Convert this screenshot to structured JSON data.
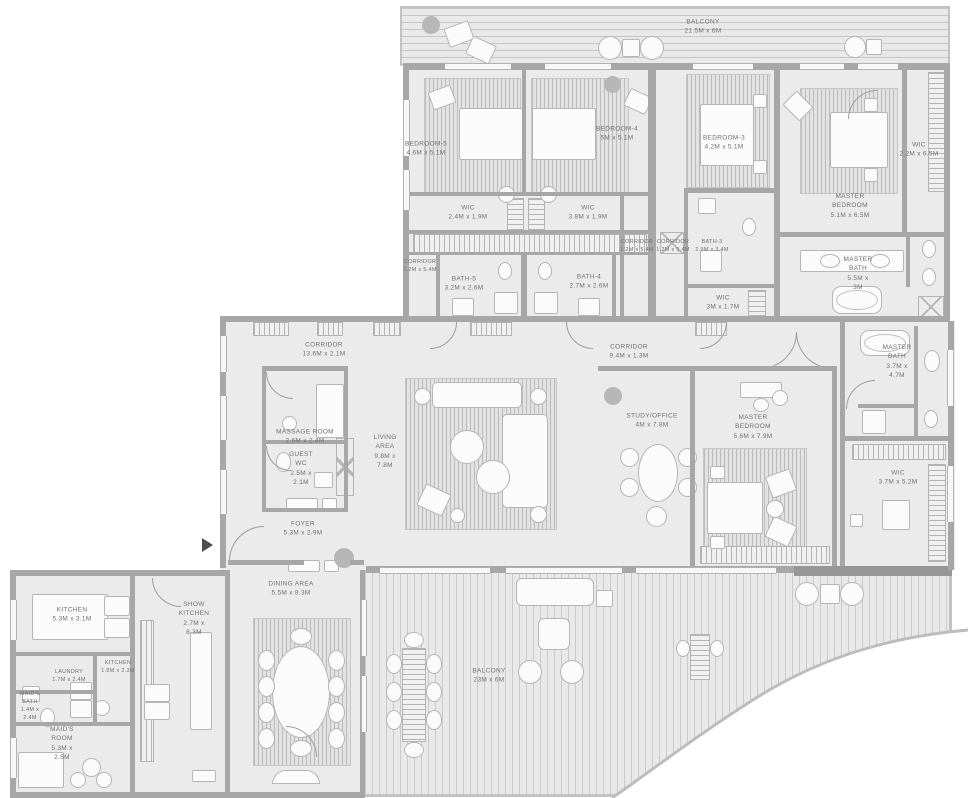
{
  "title": "Penthouse Floor Plan",
  "colors": {
    "wall": "#a7a7a7",
    "floor": "#ebebeb",
    "deck": "#e9e9e9",
    "rug": "#e2e2e2",
    "furniture": "#fbfbfb",
    "text": "#717171",
    "planter": "#b7b7b7"
  },
  "icons": {
    "entry": "entry-arrow"
  },
  "rooms": [
    {
      "id": "balcony-top",
      "name": "BALCONY",
      "dims": "21.5M x 6M"
    },
    {
      "id": "bedroom-5",
      "name": "BEDROOM-5",
      "dims": "4.6M x 5.1M"
    },
    {
      "id": "bedroom-4",
      "name": "BEDROOM-4",
      "dims": "5M x 5.1M"
    },
    {
      "id": "bedroom-3",
      "name": "BEDROOM-3",
      "dims": "4.2M x 5.1M"
    },
    {
      "id": "master-bedroom-upper",
      "name": "MASTER BEDROOM",
      "dims": "5.1M x 6.5M"
    },
    {
      "id": "wic-master-upper",
      "name": "WIC",
      "dims": "2.2M x 6.5M"
    },
    {
      "id": "wic-bedroom-5",
      "name": "WIC",
      "dims": "2.4M x 1.9M"
    },
    {
      "id": "wic-bedroom-4",
      "name": "WIC",
      "dims": "3.8M x 1.9M"
    },
    {
      "id": "corridor-bedroom-5",
      "name": "CORRIDOR",
      "dims": "1.2M x 5.4M"
    },
    {
      "id": "corridor-bedroom-4",
      "name": "CORRIDOR",
      "dims": "1.2M x 5.4M"
    },
    {
      "id": "corridor-bedroom-3",
      "name": "CORRIDOR",
      "dims": "1.2M x 5.4M"
    },
    {
      "id": "bath-5",
      "name": "BATH-5",
      "dims": "3.2M x 2.6M"
    },
    {
      "id": "bath-4",
      "name": "BATH-4",
      "dims": "2.7M x 2.6M"
    },
    {
      "id": "bath-3",
      "name": "BATH-3",
      "dims": "2.9M x 3.4M"
    },
    {
      "id": "wic-bedroom-3",
      "name": "WIC",
      "dims": "3M x 1.7M"
    },
    {
      "id": "master-bath-upper",
      "name": "MASTER BATH",
      "dims": "5.5M x 3M"
    },
    {
      "id": "corridor-main",
      "name": "CORRIDOR",
      "dims": "13.6M x 2.1M"
    },
    {
      "id": "corridor-study",
      "name": "CORRIDOR",
      "dims": "9.4M x 1.3M"
    },
    {
      "id": "massage-room",
      "name": "MASSAGE ROOM",
      "dims": "2.6M x 2.4M"
    },
    {
      "id": "guest-wc",
      "name": "GUEST WC",
      "dims": "2.5M x 2.1M"
    },
    {
      "id": "living-area",
      "name": "LIVING AREA",
      "dims": "9.8M x 7.8M"
    },
    {
      "id": "study-office",
      "name": "STUDY/OFFICE",
      "dims": "4M x 7.8M"
    },
    {
      "id": "master-bedroom-main",
      "name": "MASTER BEDROOM",
      "dims": "5.6M x 7.9M"
    },
    {
      "id": "master-bath-main",
      "name": "MASTER BATH",
      "dims": "3.7M x 4.7M"
    },
    {
      "id": "wic-master-main",
      "name": "WIC",
      "dims": "3.7M x 5.2M"
    },
    {
      "id": "foyer",
      "name": "FOYER",
      "dims": "5.3M x 2.9M"
    },
    {
      "id": "kitchen",
      "name": "KITCHEN",
      "dims": "5.3M x 3.1M"
    },
    {
      "id": "show-kitchen",
      "name": "SHOW KITCHEN",
      "dims": "2.7M x 8.3M"
    },
    {
      "id": "kitchen-2",
      "name": "KITCHEN",
      "dims": "1.8M x 2.3M"
    },
    {
      "id": "laundry",
      "name": "LAUNDRY",
      "dims": "1.7M x 2.4M"
    },
    {
      "id": "maids-bath",
      "name": "MAID'S BATH",
      "dims": "1.4M x 2.4M"
    },
    {
      "id": "maids-room",
      "name": "MAID'S ROOM",
      "dims": "5.3M x 2.5M"
    },
    {
      "id": "dining-area",
      "name": "DINING AREA",
      "dims": "5.5M x 8.3M"
    },
    {
      "id": "balcony-main",
      "name": "BALCONY",
      "dims": "23M x 6M"
    }
  ]
}
